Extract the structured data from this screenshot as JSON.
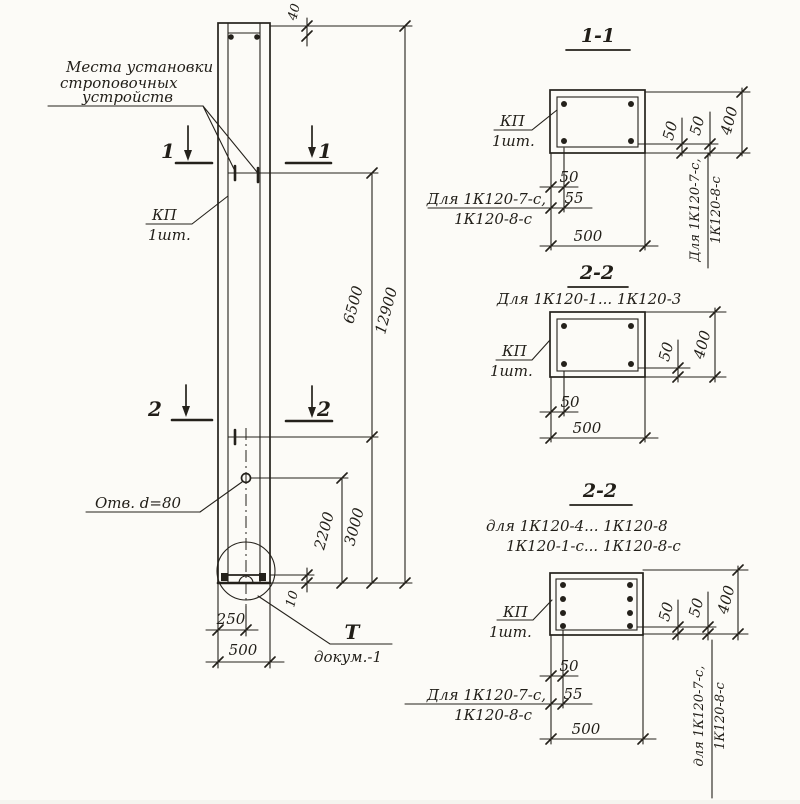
{
  "main_view": {
    "strop_note_line1": "Места установки",
    "strop_note_line2": "строповочных",
    "strop_note_line3": "устройств",
    "kp_name": "КП",
    "kp_qty": "1шт.",
    "hole_note": "Отв. d=80",
    "detail_ref_top": "Т",
    "detail_ref_bottom": "докум.-1",
    "section1_label": "1",
    "section2_label": "2",
    "dim_top": "40",
    "dim_total": "12900",
    "dim_strop_span": "6500",
    "dim_strop_bottom": "3000",
    "dim_hole_bottom": "2200",
    "dim_base": "10",
    "dim_half_width": "250",
    "dim_width": "500"
  },
  "section_1_1": {
    "title": "1-1",
    "kp_name": "КП",
    "kp_qty": "1шт.",
    "dim_50": "50",
    "dim_55": "55",
    "dim_500": "500",
    "dim_r50a": "50",
    "dim_r50b": "50",
    "dim_400": "400",
    "note_left_1": "Для 1К120-7-с,",
    "note_left_2": "1К120-8-с",
    "note_right_1": "Для 1К120-7-с,",
    "note_right_2": "1К120-8-с"
  },
  "section_2_2_a": {
    "title": "2-2",
    "subtitle": "Для 1К120-1... 1К120-3",
    "kp_name": "КП",
    "kp_qty": "1шт.",
    "dim_50": "50",
    "dim_500": "500",
    "dim_r50": "50",
    "dim_400": "400"
  },
  "section_2_2_b": {
    "title": "2-2",
    "subtitle_1": "для 1К120-4... 1К120-8",
    "subtitle_2": "1К120-1-с... 1К120-8-с",
    "kp_name": "КП",
    "kp_qty": "1шт.",
    "dim_50": "50",
    "dim_55": "55",
    "dim_500": "500",
    "dim_r50a": "50",
    "dim_r50b": "50",
    "dim_400": "400",
    "note_left_1": "Для 1К120-7-с,",
    "note_left_2": "1К120-8-с",
    "note_right_1": "для 1К120-7-с,",
    "note_right_2": "1К120-8-с"
  }
}
